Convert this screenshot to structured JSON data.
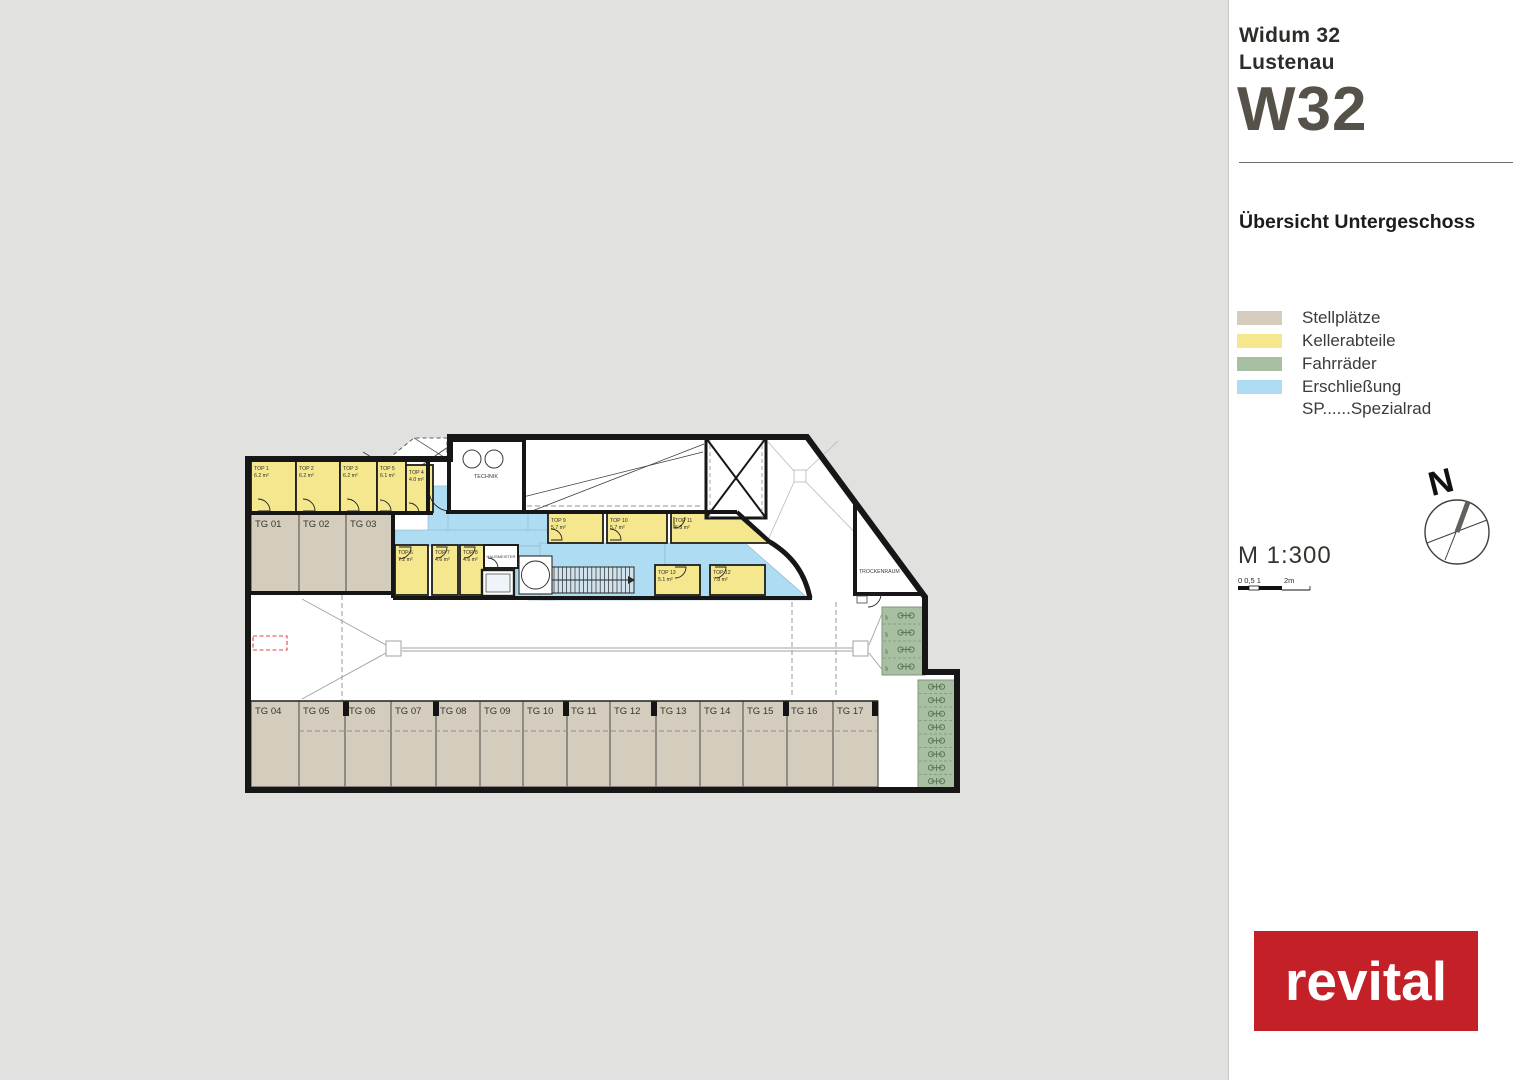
{
  "header": {
    "project_line1": "Widum 32",
    "project_line2": "Lustenau",
    "project_code": "W32",
    "code_color": "#56524a",
    "subtitle": "Übersicht Untergeschoss"
  },
  "legend": {
    "items": [
      {
        "key": "stellplaetze",
        "label": "Stellplätze"
      },
      {
        "key": "kellerabteile",
        "label": "Kellerabteile"
      },
      {
        "key": "fahrraeder",
        "label": "Fahrräder"
      },
      {
        "key": "erschliessung",
        "label": "Erschließung"
      }
    ],
    "note": "SP......Spezialrad"
  },
  "compass": {
    "north_label": "N"
  },
  "scale": {
    "label": "M 1:300",
    "ticks_label": "0 0,5 1",
    "end_label": "2m"
  },
  "logo": {
    "text": "revital",
    "color": "#c32027"
  },
  "colors": {
    "background": "#e1e1df",
    "paper": "#ffffff",
    "wall": "#161616",
    "stellplaetze": "#d4ccbd",
    "kellerabteile": "#f5e78d",
    "fahrraeder": "#a9bfa1",
    "erschliessung": "#aedcf2",
    "line": "#a2a29d",
    "text": "#2e2e2a",
    "red_dash": "#e0453c",
    "bike": "#5c7a58"
  },
  "plan": {
    "outline": "248,459 450,459 450,437 807,437 925,597 925,672 957,672 957,790 248,790",
    "cellar_rooms": [
      {
        "name": "TOP 1",
        "area": "6.2 m²",
        "rect": [
          251,
          461,
          45,
          51
        ]
      },
      {
        "name": "TOP 2",
        "area": "6.2 m²",
        "rect": [
          296,
          461,
          44,
          51
        ]
      },
      {
        "name": "TOP 3",
        "area": "6.2 m²",
        "rect": [
          340,
          461,
          37,
          51
        ]
      },
      {
        "name": "TOP 5",
        "area": "6.1 m²",
        "rect": [
          377,
          461,
          29,
          51
        ]
      },
      {
        "name": "TOP 4",
        "area": "4.0 m²",
        "rect": [
          406,
          465,
          27,
          47
        ]
      },
      {
        "name": "TOP 6",
        "area": "7.2 m²",
        "rect": [
          395,
          545,
          33,
          50
        ]
      },
      {
        "name": "TOP 7",
        "area": "4.6 m²",
        "rect": [
          432,
          545,
          26,
          50
        ]
      },
      {
        "name": "TOP 8",
        "area": "4.6 m²",
        "rect": [
          460,
          545,
          26,
          50
        ]
      },
      {
        "name": "TOP 9",
        "area": "5.7 m²",
        "rect": [
          548,
          513,
          55,
          30
        ]
      },
      {
        "name": "TOP 10",
        "area": "5.7 m²",
        "rect": [
          607,
          513,
          60,
          30
        ]
      },
      {
        "name": "TOP 11",
        "area": "6.8 m²",
        "poly": "671,513 735,513 769,543 671,543",
        "label": [
          675,
          522
        ]
      },
      {
        "name": "TOP 13",
        "area": "5.1 m²",
        "rect": [
          655,
          565,
          45,
          30
        ]
      },
      {
        "name": "TOP 12",
        "area": "7.8 m²",
        "rect": [
          710,
          565,
          55,
          30
        ]
      }
    ],
    "garage_top": [
      {
        "name": "TG 01",
        "x": 251,
        "w": 48
      },
      {
        "name": "TG 02",
        "x": 299,
        "w": 47
      },
      {
        "name": "TG 03",
        "x": 346,
        "w": 47
      }
    ],
    "garage_bottom": [
      {
        "name": "TG 04",
        "x": 251,
        "w": 48
      },
      {
        "name": "TG 05",
        "x": 299,
        "w": 46
      },
      {
        "name": "TG 06",
        "x": 345,
        "w": 46
      },
      {
        "name": "TG 07",
        "x": 391,
        "w": 45
      },
      {
        "name": "TG 08",
        "x": 436,
        "w": 44
      },
      {
        "name": "TG 09",
        "x": 480,
        "w": 43
      },
      {
        "name": "TG 10",
        "x": 523,
        "w": 44
      },
      {
        "name": "TG 11",
        "x": 567,
        "w": 43
      },
      {
        "name": "TG 12",
        "x": 610,
        "w": 46
      },
      {
        "name": "TG 13",
        "x": 656,
        "w": 44
      },
      {
        "name": "TG 14",
        "x": 700,
        "w": 43
      },
      {
        "name": "TG 15",
        "x": 743,
        "w": 44
      },
      {
        "name": "TG 16",
        "x": 787,
        "w": 46
      },
      {
        "name": "TG 17",
        "x": 833,
        "w": 45
      }
    ],
    "labels": {
      "technik": "TECHNIK",
      "hausmeister": "HAUSMEISTER",
      "trockenraum": "TROCKENRAUM",
      "sp": "SP"
    }
  }
}
